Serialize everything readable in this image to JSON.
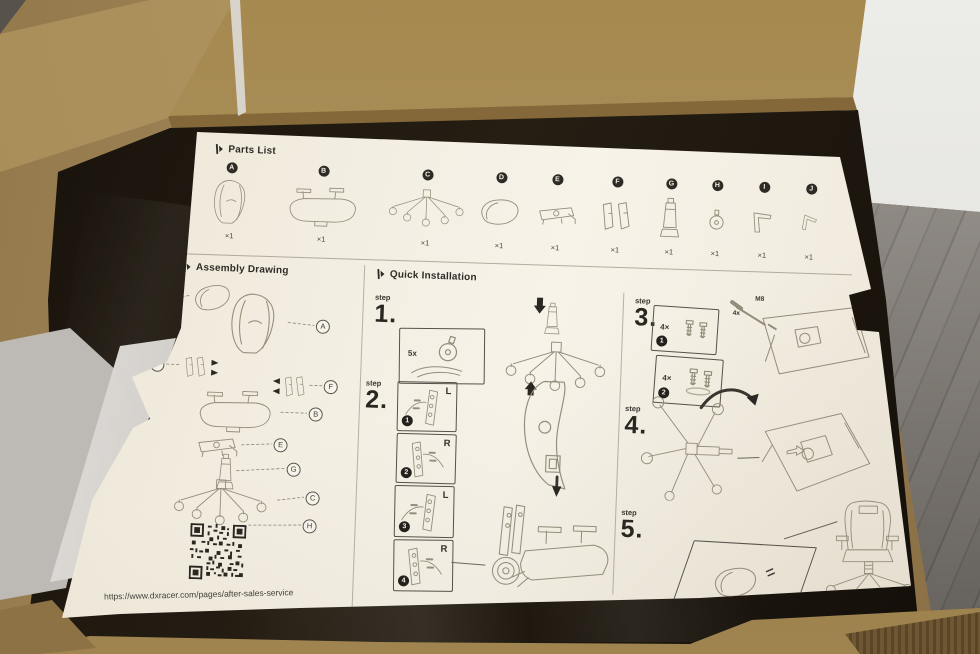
{
  "colors": {
    "cardboard": "#a2875a",
    "cardboard_dark": "#7c6238",
    "box_interior": "#1b150e",
    "wall": "#e9e9e7",
    "floor": "#95908a",
    "foam": "#d7d4d0",
    "paper": "#f3eee2",
    "ink": "#2e2b26",
    "sketch": "#948d7b"
  },
  "sheet": {
    "parts_list": {
      "title": "Parts List",
      "items": [
        {
          "id": "A",
          "qty": "×1",
          "icon": "backrest"
        },
        {
          "id": "B",
          "qty": "×1",
          "icon": "seat-with-armrests"
        },
        {
          "id": "C",
          "qty": "×1",
          "icon": "five-star-base"
        },
        {
          "id": "D",
          "qty": "×1",
          "icon": "headrest-pillow"
        },
        {
          "id": "E",
          "qty": "×1",
          "icon": "tilt-mechanism"
        },
        {
          "id": "F",
          "qty": "×1",
          "icon": "side-covers"
        },
        {
          "id": "G",
          "qty": "×1",
          "icon": "gas-lift"
        },
        {
          "id": "H",
          "qty": "×1",
          "icon": "caster"
        },
        {
          "id": "I",
          "qty": "×1",
          "icon": "allen-key-large"
        },
        {
          "id": "J",
          "qty": "×1",
          "icon": "allen-key-small"
        }
      ]
    },
    "assembly_drawing": {
      "title": "Assembly Drawing",
      "callouts": [
        "D",
        "A",
        "F",
        "F",
        "B",
        "E",
        "G",
        "C",
        "H"
      ],
      "url": "https://www.dxracer.com/pages/after-sales-service"
    },
    "quick_installation": {
      "title": "Quick Installation",
      "step_label": "step",
      "steps": {
        "s1": {
          "num": "1.",
          "qty": "5x"
        },
        "s2": {
          "num": "2.",
          "boxes": [
            {
              "side": "L",
              "bullet": "1"
            },
            {
              "side": "R",
              "bullet": "2"
            },
            {
              "side": "L",
              "bullet": "3"
            },
            {
              "side": "R",
              "bullet": "4"
            }
          ]
        },
        "s3": {
          "num": "3.",
          "boxes": [
            {
              "qty": "4×",
              "bullet": "1"
            },
            {
              "qty": "4×",
              "bullet": "2"
            }
          ],
          "screw_size": "M8",
          "screw_qty": "4x"
        },
        "s4": {
          "num": "4."
        },
        "s5": {
          "num": "5."
        }
      }
    }
  }
}
